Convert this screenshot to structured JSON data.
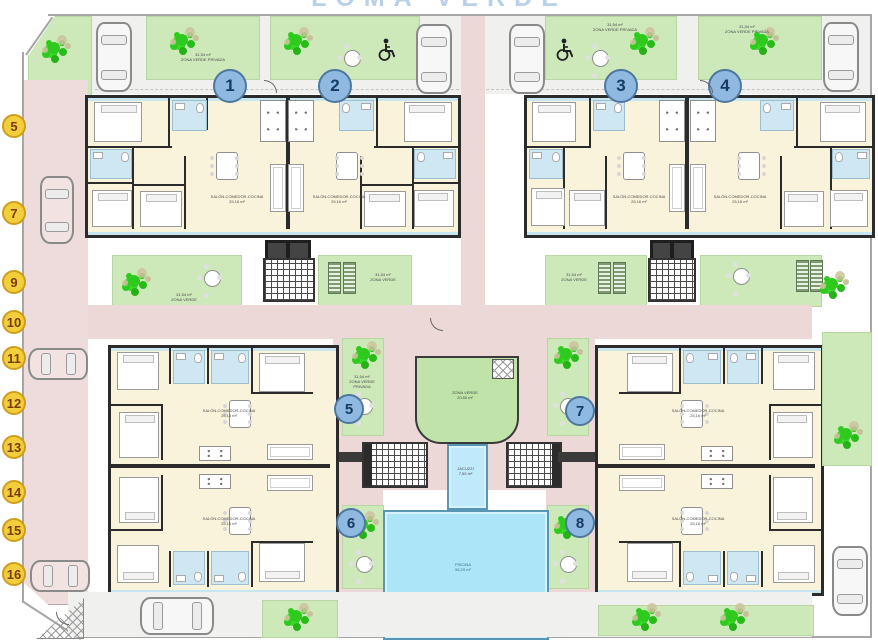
{
  "title": "LOMA VERDE",
  "units": [
    {
      "number": "1"
    },
    {
      "number": "2"
    },
    {
      "number": "3"
    },
    {
      "number": "4"
    },
    {
      "number": "5"
    },
    {
      "number": "6"
    },
    {
      "number": "7"
    },
    {
      "number": "8"
    }
  ],
  "parking": {
    "spots": [
      "5",
      "7",
      "9",
      "10",
      "11",
      "12",
      "13",
      "14",
      "15",
      "16"
    ]
  },
  "labels": {
    "living": "SALÓN-COMEDOR-COCINA",
    "living_area": "25,16 m²",
    "garden": "ZONA VERDE PRIVADA",
    "garden_area": "31,54 m²",
    "common_green": "ZONA VERDE",
    "common_green_area": "20,50 m²",
    "jacuzzi": "JACUZZI",
    "jacuzzi_area": "7,50 m²",
    "pool": "PISCINA",
    "pool_area": "55,29 m²"
  },
  "colors": {
    "road_pink": "#ecd8d7",
    "garden_green": "#cde9ba",
    "tree_green": "#2ecb1e",
    "interior_cream": "#faf3dc",
    "bath_blue": "#cfe7f3",
    "pool_blue": "#ade5f8",
    "unit_badge": "#8fb9e0",
    "unit_badge_border": "#4d779f",
    "parking_badge": "#f2cf3a",
    "parking_badge_border": "#cf9d1b"
  }
}
